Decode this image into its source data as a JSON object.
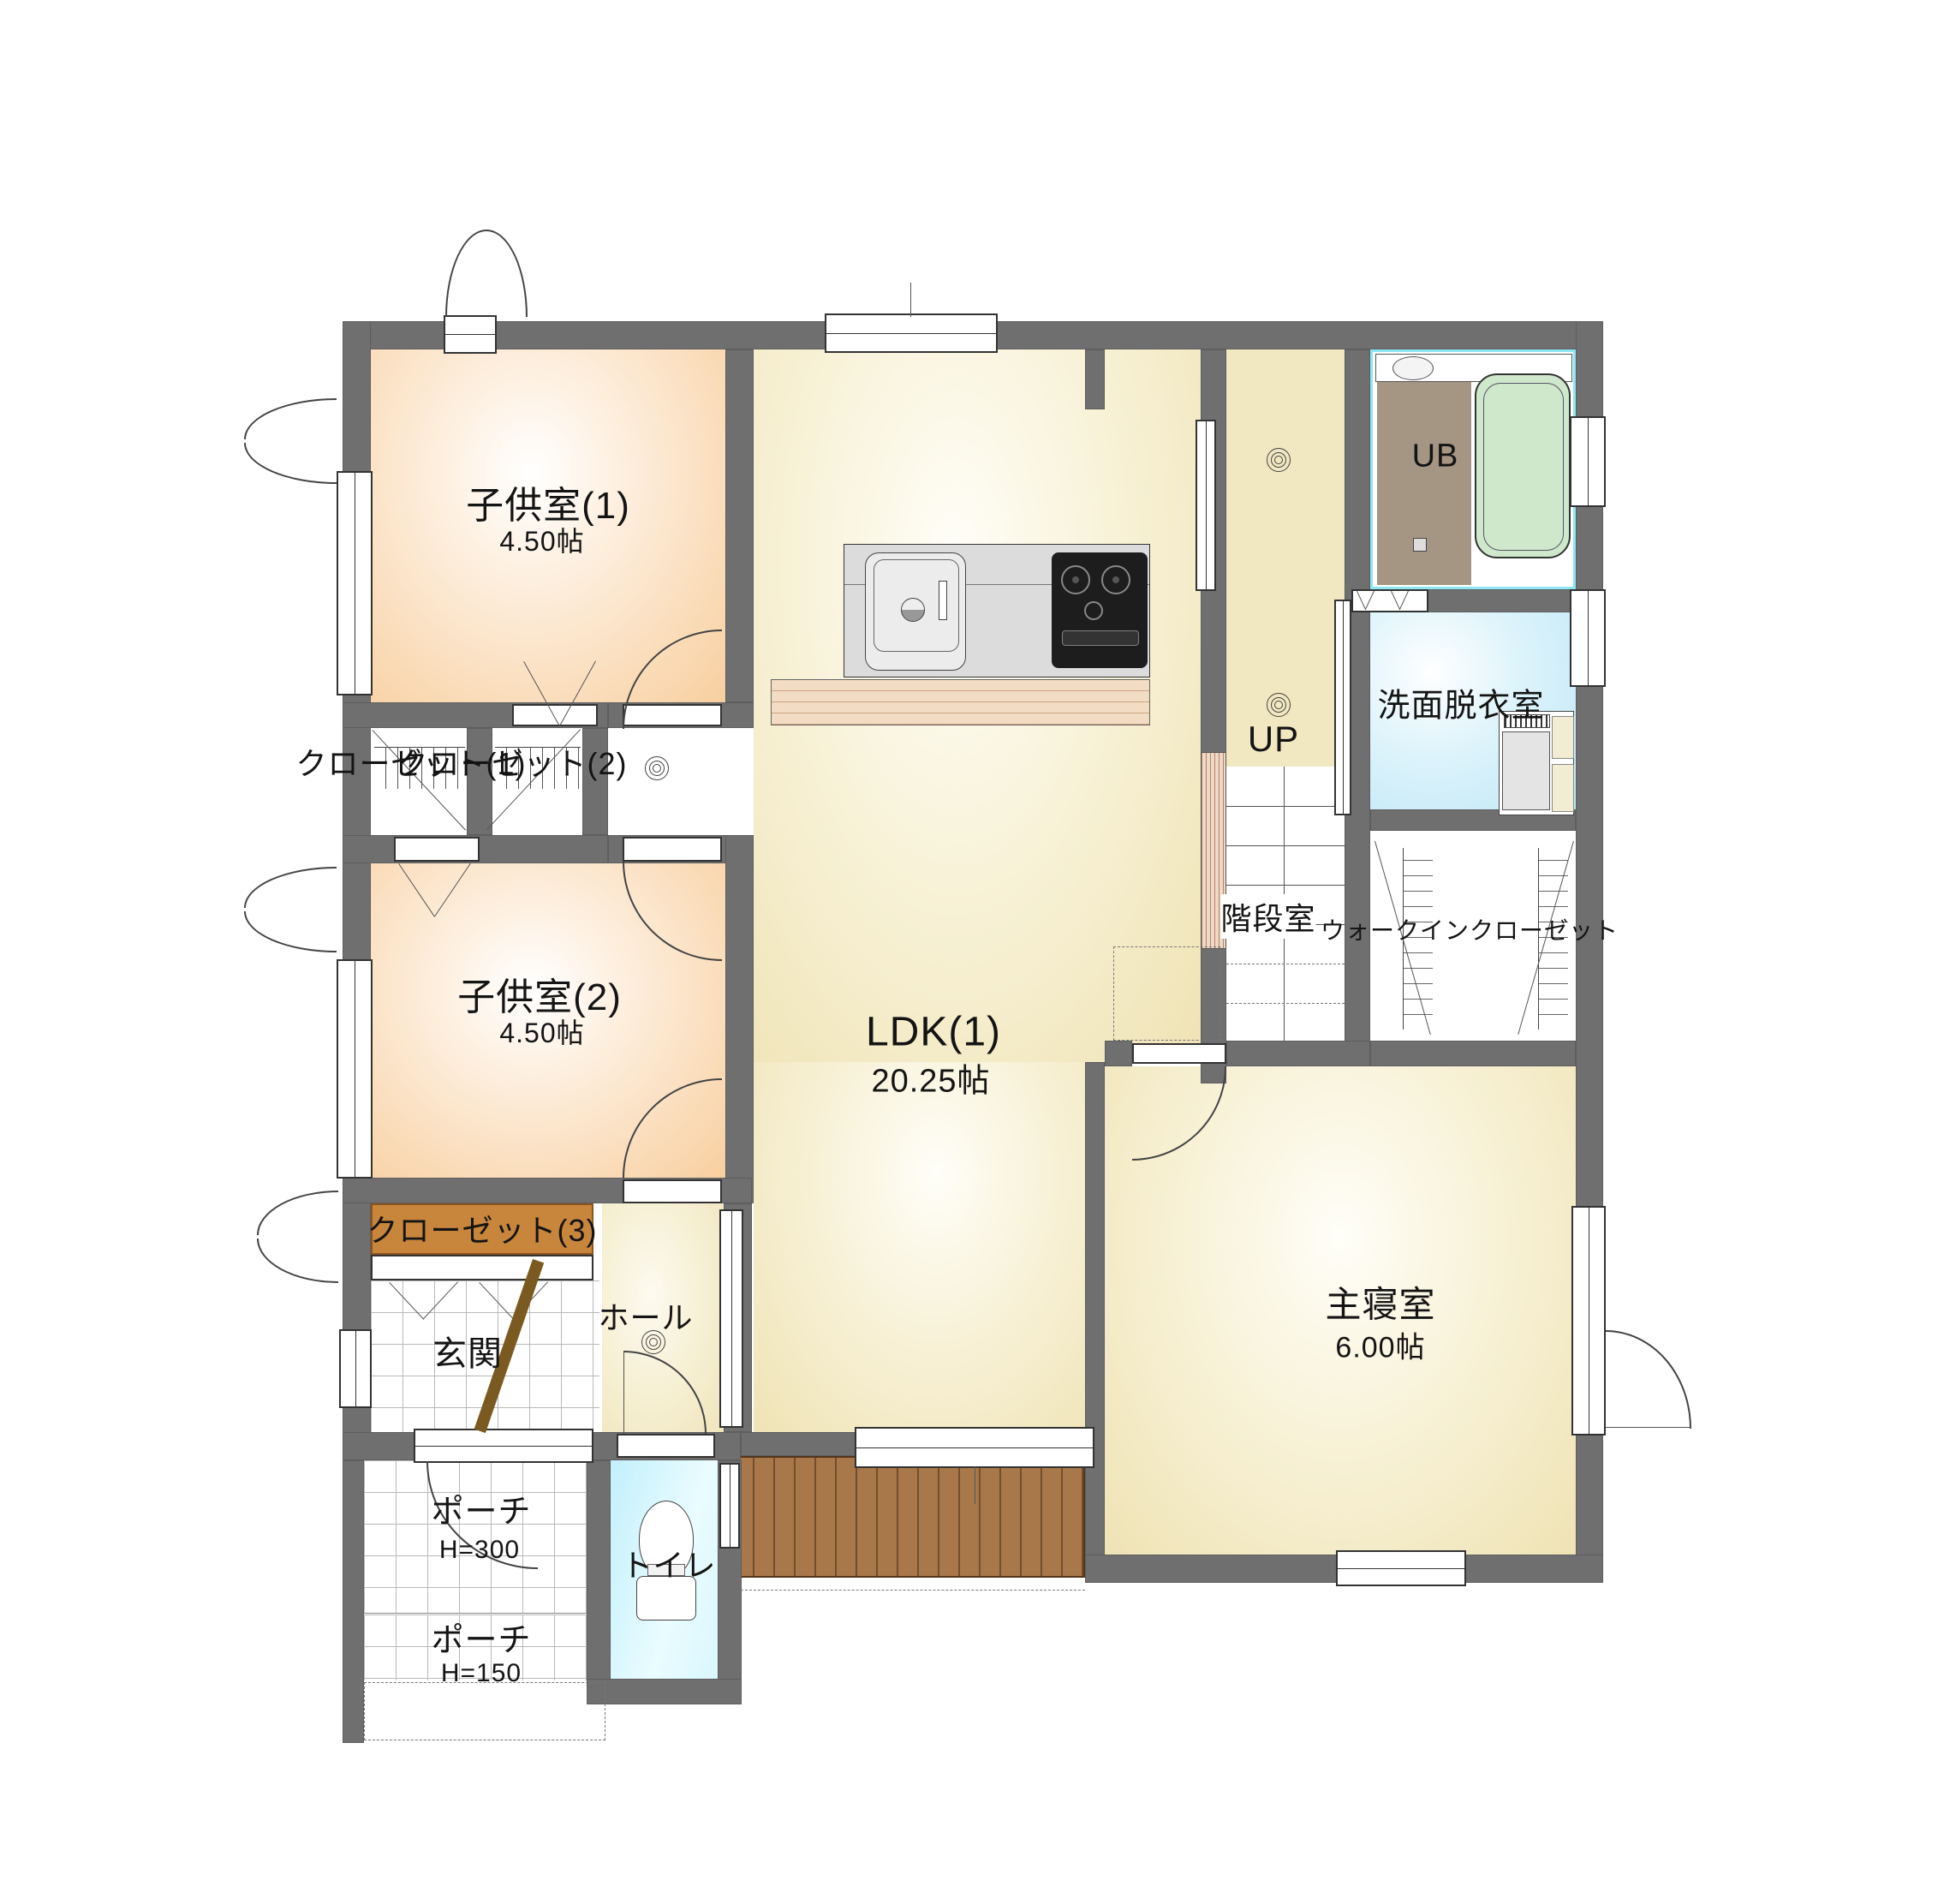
{
  "plan": {
    "title": "1F floor plan",
    "rooms": {
      "kids1": {
        "name": "子供室(1)",
        "size": "4.50帖"
      },
      "kids2": {
        "name": "子供室(2)",
        "size": "4.50帖"
      },
      "ldk": {
        "name": "LDK(1)",
        "size": "20.25帖"
      },
      "master": {
        "name": "主寝室",
        "size": "6.00帖"
      },
      "unit_bath": {
        "name": "UB"
      },
      "washroom": {
        "name": "洗面脱衣室"
      },
      "stair_room": {
        "name": "階段室"
      },
      "stair_direction": {
        "name": "UP"
      },
      "wic": {
        "name": "ウォークインクローゼット"
      },
      "closet1": {
        "name": "クローゼット(1)"
      },
      "closet2": {
        "name": "クローゼット(2)"
      },
      "closet3": {
        "name": "クローゼット(3)"
      },
      "hall": {
        "name": "ホール"
      },
      "entrance": {
        "name": "玄関"
      },
      "porch_upper": {
        "name": "ポーチ",
        "height": "H=300"
      },
      "porch_lower": {
        "name": "ポーチ",
        "height": "H=150"
      },
      "toilet": {
        "name": "トイレ"
      }
    },
    "colors": {
      "wall": "#6f6f6f",
      "kids_room": "#f8cf9f",
      "ldk_floor": "#efe3b4",
      "washroom": "#bfe7f6",
      "toilet": "#c2f0fb",
      "ub_floor": "#a59583",
      "bathtub": "#cfe7cb",
      "deck": "#a8784a",
      "closet3_fill": "#c8853c"
    }
  }
}
